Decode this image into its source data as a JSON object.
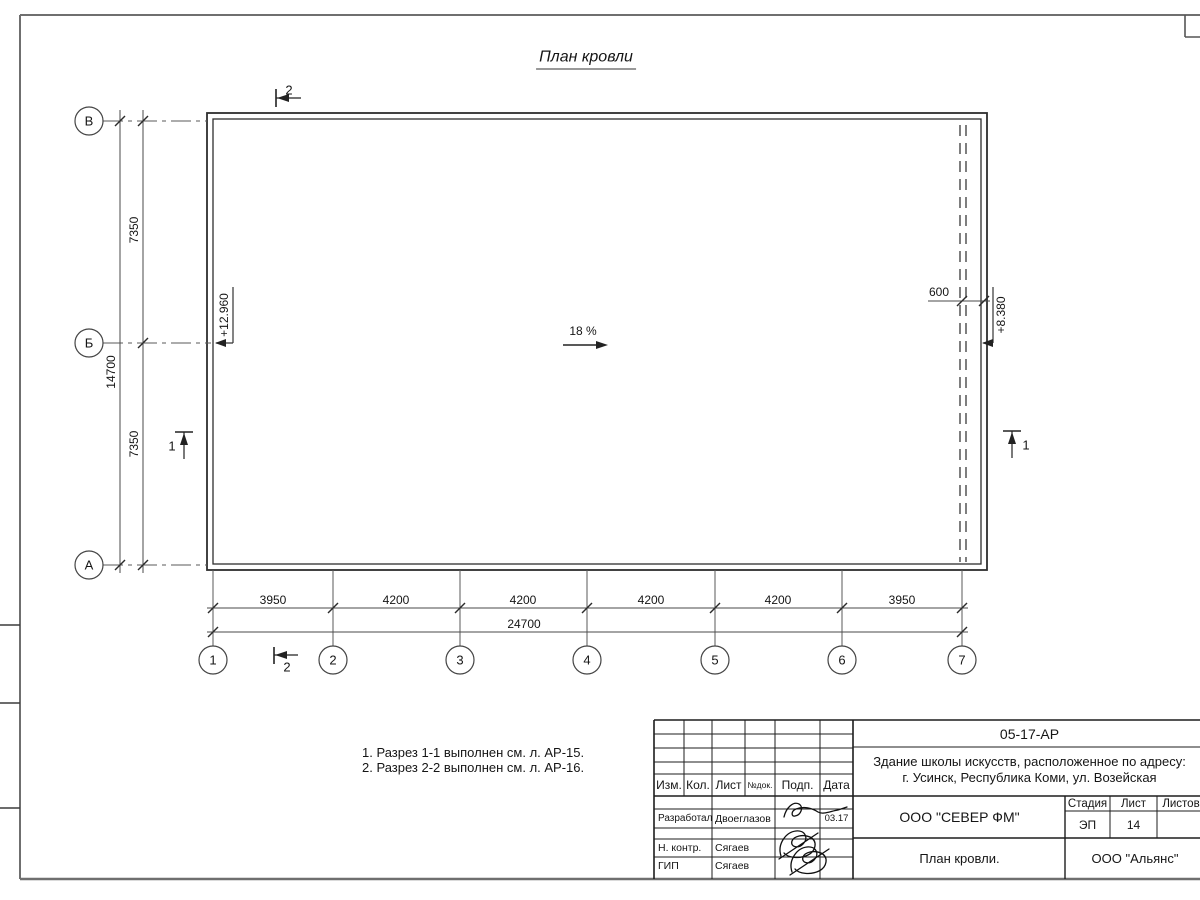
{
  "sheet": {
    "title": "План кровли",
    "notes": [
      "1. Разрез 1-1 выполнен см. л. АР-15.",
      "2. Разрез 2-2 выполнен см. л. АР-16."
    ]
  },
  "plan": {
    "slope": "18 %",
    "elevation_left": "+12.960",
    "elevation_right": "+8.380",
    "parapet_offset": "600",
    "section_1": "1",
    "section_2": "2"
  },
  "grid": {
    "row_labels": [
      "В",
      "Б",
      "А"
    ],
    "col_labels": [
      "1",
      "2",
      "3",
      "4",
      "5",
      "6",
      "7"
    ]
  },
  "dimensions": {
    "left_upper": "7350",
    "left_total": "14700",
    "left_lower": "7350",
    "bottom": [
      "3950",
      "4200",
      "4200",
      "4200",
      "4200",
      "3950"
    ],
    "bottom_total": "24700"
  },
  "titleblock": {
    "doc_number": "05-17-АР",
    "project_line1": "Здание школы искусств, расположенное по адресу:",
    "project_line2": "г. Усинск, Республика Коми, ул. Возейская",
    "col_headers": [
      "Изм.",
      "Кол.",
      "Лист",
      "№док.",
      "Подп.",
      "Дата"
    ],
    "signers": [
      {
        "role": "Разработал",
        "name": "Двоеглазов",
        "date": "03.17"
      },
      {
        "role": "Н. контр.",
        "name": "Сягаев",
        "date": ""
      },
      {
        "role": "ГИП",
        "name": "Сягаев",
        "date": ""
      }
    ],
    "company": "ООО \"СЕВЕР ФМ\"",
    "stage_header": "Стадия",
    "sheet_header": "Лист",
    "sheets_header": "Листов",
    "stage": "ЭП",
    "sheet_number": "14",
    "drawing_name": "План кровли.",
    "contractor": "ООО \"Альянс\""
  }
}
